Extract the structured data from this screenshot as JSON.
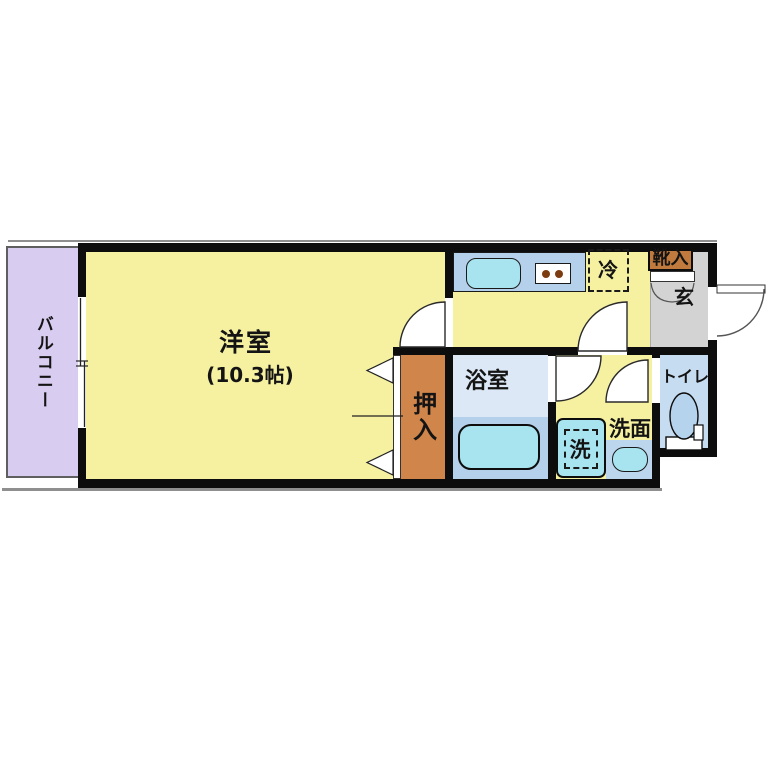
{
  "floorplan": {
    "labels": {
      "balcony": "バルコニー",
      "room": "洋室",
      "room_size": "(10.3帖)",
      "closet": "押入",
      "bathroom": "浴室",
      "washer": "洗",
      "vanity": "洗面",
      "toilet": "トイレ",
      "fridge": "冷",
      "shoe_cabinet": "靴入",
      "entrance": "玄"
    },
    "colors": {
      "wall": "#0d0d0d",
      "room_floor": "#f5f1a1",
      "balcony": "#d9ccf1",
      "counter_blue": "#b4d0ea",
      "fixture_cyan": "#a8e4f0",
      "bath_upper": "#dce8f5",
      "toilet_floor": "#c6dcf0",
      "vanity_counter": "#bcd6ee",
      "closet_brown": "#d0854a",
      "shoe_brown": "#c07a3e",
      "entrance_gray": "#d3d3d3",
      "shadow_gray": "#8f8f8f"
    }
  }
}
